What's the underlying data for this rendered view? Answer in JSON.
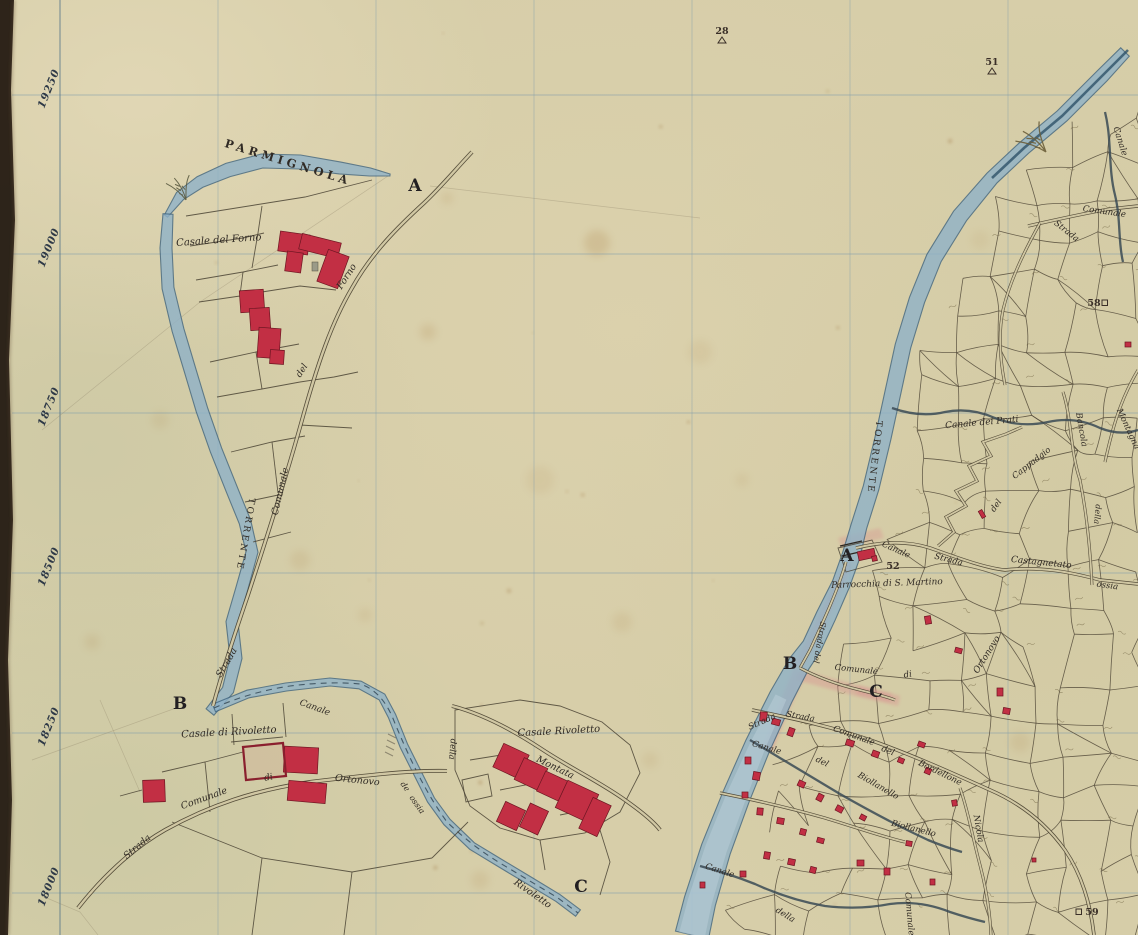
{
  "map": {
    "margin_coordinates": [
      "19250",
      "19000",
      "18750",
      "18500",
      "18250",
      "18000"
    ],
    "corner_letters": [
      {
        "t": "A",
        "x": 415,
        "y": 191
      },
      {
        "t": "B",
        "x": 180,
        "y": 709
      },
      {
        "t": "C",
        "x": 581,
        "y": 892
      },
      {
        "t": "A",
        "x": 847,
        "y": 561
      },
      {
        "t": "B",
        "x": 790,
        "y": 669
      },
      {
        "t": "C",
        "x": 876,
        "y": 697
      }
    ],
    "survey_points": [
      {
        "n": "28",
        "sym": "tri",
        "x": 722,
        "y": 34
      },
      {
        "n": "51",
        "sym": "tri",
        "x": 992,
        "y": 65
      },
      {
        "n": "58",
        "sym": "sq-right",
        "x": 1094,
        "y": 306
      },
      {
        "n": "59",
        "sym": "sq-left",
        "x": 1092,
        "y": 915
      },
      {
        "n": "52",
        "sym": "none",
        "x": 893,
        "y": 569
      }
    ],
    "labels": [
      {
        "t": "PARMIGNOLA",
        "x": 287,
        "y": 166,
        "r": 17,
        "s": 11.5,
        "ls": 4,
        "st": "c"
      },
      {
        "t": "Casale del Forno",
        "x": 219,
        "y": 243,
        "r": -4,
        "s": 10,
        "st": "i"
      },
      {
        "t": "Forno",
        "x": 349,
        "y": 278,
        "r": -57,
        "s": 9.5,
        "st": "i"
      },
      {
        "t": "del",
        "x": 304,
        "y": 372,
        "r": -57,
        "s": 9,
        "st": "i"
      },
      {
        "t": "Comunale",
        "x": 283,
        "y": 492,
        "r": -77,
        "s": 9.5,
        "st": "i"
      },
      {
        "t": "Strada",
        "x": 229,
        "y": 664,
        "r": -60,
        "s": 9.5,
        "st": "i"
      },
      {
        "t": "TORRENTE",
        "x": 243,
        "y": 534,
        "r": 100,
        "s": 9,
        "ls": 2.5,
        "st": "c"
      },
      {
        "t": "Casale di Rivoletto",
        "x": 229,
        "y": 735,
        "r": -3,
        "s": 10,
        "st": "i"
      },
      {
        "t": "Canale",
        "x": 314,
        "y": 710,
        "r": 20,
        "s": 9,
        "st": "i"
      },
      {
        "t": "Strada",
        "x": 139,
        "y": 849,
        "r": -40,
        "s": 9.5,
        "st": "i"
      },
      {
        "t": "Comunale",
        "x": 205,
        "y": 801,
        "r": -20,
        "s": 9.5,
        "st": "i"
      },
      {
        "t": "di",
        "x": 269,
        "y": 780,
        "r": -12,
        "s": 9,
        "st": "i"
      },
      {
        "t": "Ortonovo",
        "x": 357,
        "y": 783,
        "r": 6,
        "s": 9.5,
        "st": "i"
      },
      {
        "t": "de",
        "x": 403,
        "y": 788,
        "r": 55,
        "s": 8,
        "st": "i"
      },
      {
        "t": "ossia",
        "x": 415,
        "y": 806,
        "r": 55,
        "s": 8,
        "st": "i"
      },
      {
        "t": "Casale Rivoletto",
        "x": 559,
        "y": 734,
        "r": -3,
        "s": 10,
        "st": "i"
      },
      {
        "t": "della",
        "x": 450,
        "y": 749,
        "r": 95,
        "s": 8.5,
        "st": "i"
      },
      {
        "t": "Montata",
        "x": 554,
        "y": 770,
        "r": 26,
        "s": 9.5,
        "st": "i"
      },
      {
        "t": "Rivoletto",
        "x": 531,
        "y": 896,
        "r": 35,
        "s": 9.5,
        "st": "i"
      },
      {
        "t": "TORRENTE",
        "x": 872,
        "y": 457,
        "r": 97,
        "s": 9,
        "ls": 2.5,
        "st": "c"
      },
      {
        "t": "Parrocchia di S. Martino",
        "x": 887,
        "y": 586,
        "r": -2,
        "s": 9,
        "st": "i"
      },
      {
        "t": "Canale",
        "x": 895,
        "y": 552,
        "r": 24,
        "s": 8.5,
        "st": "i"
      },
      {
        "t": "Strada",
        "x": 948,
        "y": 562,
        "r": 14,
        "s": 8.5,
        "st": "i"
      },
      {
        "t": "Canale dei Prati",
        "x": 982,
        "y": 425,
        "r": -5,
        "s": 9,
        "st": "i"
      },
      {
        "t": "Bancola",
        "x": 1079,
        "y": 430,
        "r": 80,
        "s": 8.5,
        "st": "i"
      },
      {
        "t": "Montagna",
        "x": 1126,
        "y": 430,
        "r": 65,
        "s": 8.5,
        "st": "i"
      },
      {
        "t": "Comunale",
        "x": 1104,
        "y": 214,
        "r": 8,
        "s": 8.5,
        "st": "i"
      },
      {
        "t": "Strada",
        "x": 1065,
        "y": 233,
        "r": 38,
        "s": 8.5,
        "st": "i"
      },
      {
        "t": "Canale",
        "x": 1118,
        "y": 142,
        "r": 72,
        "s": 8.5,
        "st": "i"
      },
      {
        "t": "Castagnetato",
        "x": 1041,
        "y": 565,
        "r": 6,
        "s": 9,
        "st": "i"
      },
      {
        "t": "ossia",
        "x": 1107,
        "y": 588,
        "r": 8,
        "s": 8.5,
        "st": "i"
      },
      {
        "t": "del",
        "x": 998,
        "y": 507,
        "r": -55,
        "s": 8.5,
        "st": "i"
      },
      {
        "t": "Cappadgio",
        "x": 1033,
        "y": 465,
        "r": -38,
        "s": 8.5,
        "st": "i"
      },
      {
        "t": "della",
        "x": 1095,
        "y": 514,
        "r": 95,
        "s": 8,
        "st": "i"
      },
      {
        "t": "Ortonovo",
        "x": 989,
        "y": 656,
        "r": -58,
        "s": 9,
        "st": "i"
      },
      {
        "t": "Comunale",
        "x": 856,
        "y": 672,
        "r": 6,
        "s": 8.5,
        "st": "i"
      },
      {
        "t": "di",
        "x": 908,
        "y": 677,
        "r": -8,
        "s": 8.5,
        "st": "i"
      },
      {
        "t": "Strada del",
        "x": 817,
        "y": 642,
        "r": 100,
        "s": 8,
        "st": "i"
      },
      {
        "t": "Strada",
        "x": 763,
        "y": 724,
        "r": -24,
        "s": 8.5,
        "st": "i"
      },
      {
        "t": "Strada",
        "x": 800,
        "y": 719,
        "r": 10,
        "s": 8.5,
        "st": "i"
      },
      {
        "t": "Comunale",
        "x": 853,
        "y": 738,
        "r": 20,
        "s": 8.5,
        "st": "i"
      },
      {
        "t": "del",
        "x": 887,
        "y": 753,
        "r": 22,
        "s": 8.5,
        "st": "i"
      },
      {
        "t": "Bordellone",
        "x": 939,
        "y": 775,
        "r": 26,
        "s": 8.5,
        "st": "i"
      },
      {
        "t": "Canale",
        "x": 766,
        "y": 750,
        "r": 16,
        "s": 8.5,
        "st": "i"
      },
      {
        "t": "del",
        "x": 821,
        "y": 764,
        "r": 26,
        "s": 8.5,
        "st": "i"
      },
      {
        "t": "Biollanello",
        "x": 877,
        "y": 788,
        "r": 30,
        "s": 8.5,
        "st": "i"
      },
      {
        "t": "Biollanello",
        "x": 913,
        "y": 831,
        "r": 14,
        "s": 8.5,
        "st": "i"
      },
      {
        "t": "Nicola",
        "x": 976,
        "y": 829,
        "r": 80,
        "s": 8.5,
        "st": "i"
      },
      {
        "t": "Canale",
        "x": 719,
        "y": 873,
        "r": 18,
        "s": 8.5,
        "st": "i"
      },
      {
        "t": "della",
        "x": 784,
        "y": 917,
        "r": 32,
        "s": 8.5,
        "st": "i"
      },
      {
        "t": "Comunale",
        "x": 907,
        "y": 914,
        "r": 85,
        "s": 8.5,
        "st": "i"
      }
    ],
    "colors": {
      "paper": "#d7cea9",
      "water": "#8fb2c8",
      "water_edge": "#3f647f",
      "ink": "#4a4334",
      "building": "#c22f44",
      "building_edge": "#6d1622",
      "grid": "#7f9cab",
      "margin_ink": "#2e3947",
      "label_ink": "#302a24",
      "pink": "#d98f8f"
    }
  }
}
